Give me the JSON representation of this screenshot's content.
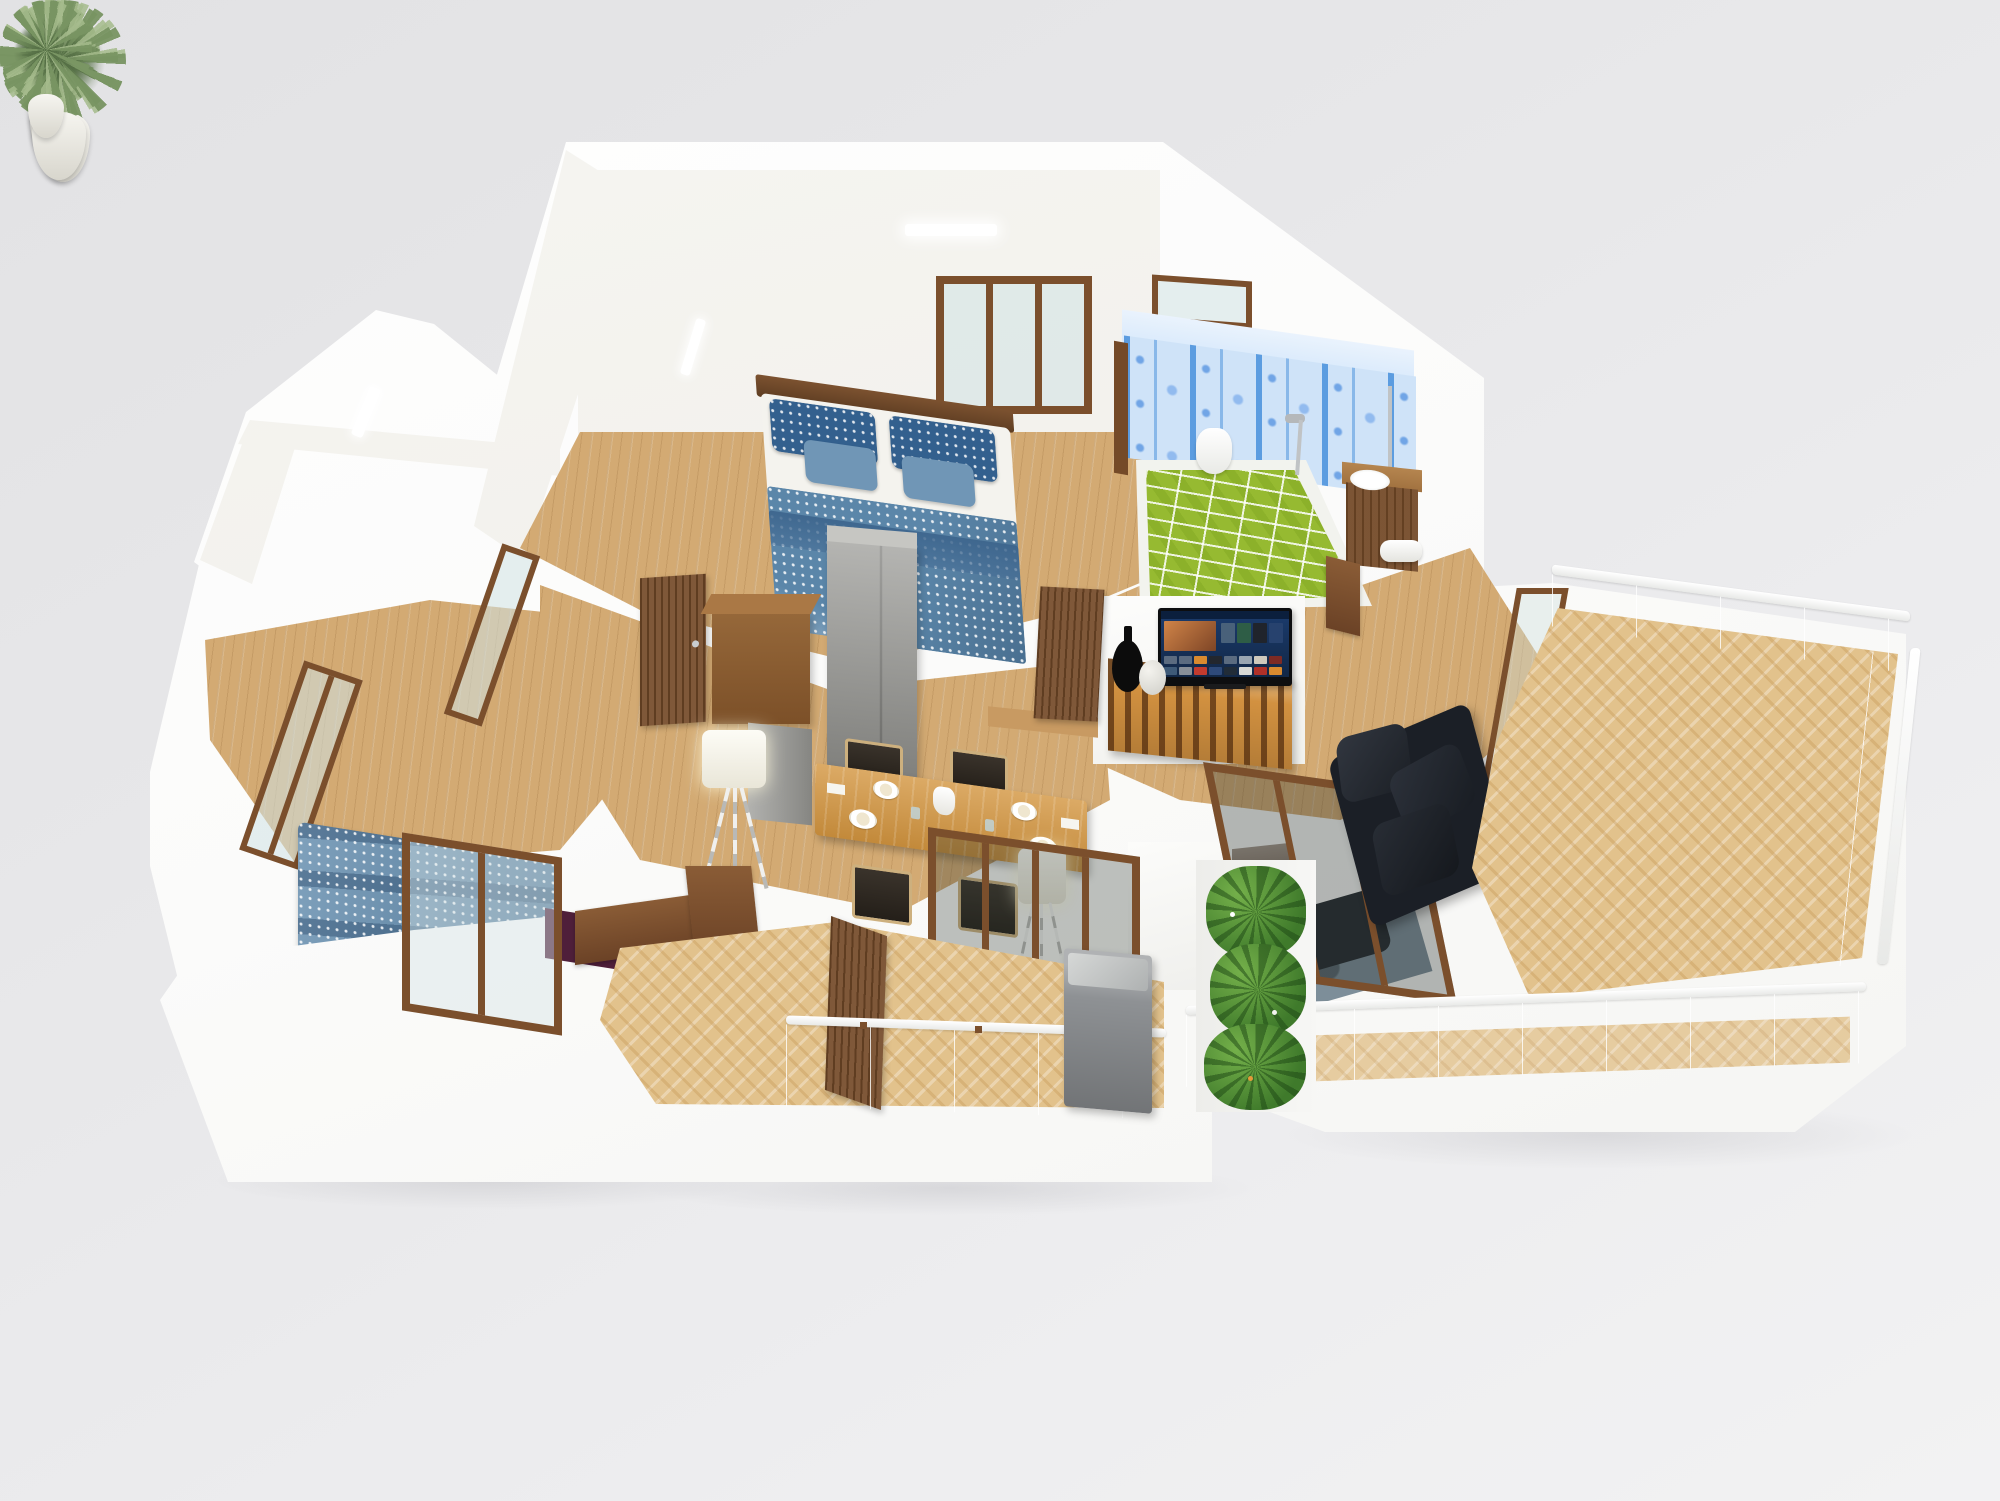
{
  "scene": {
    "description": "3D isometric cutaway floor plan render of a penthouse apartment level with bedrooms, bathroom, living-dining room, balcony, terrace and staircase",
    "background": "#e7e7e9",
    "colors": {
      "wall_white": "#fcfcfb",
      "wall_cream": "#efece5",
      "floor_wood": "#d3aa73",
      "floor_herringbone": "#e2c28c",
      "bed_blue": "#5b86a9",
      "pillow_dark_blue": "#33608e",
      "pillow_light_blue": "#7096b6",
      "wallpaper_blue": "#cfe3f8",
      "stripe_blue": "#4f95dd",
      "tile_green": "#96ba31",
      "sofa_black": "#1b1f26",
      "console_orange": "#d29140",
      "table_orange": "#d3953f",
      "door_wood": "#744a28",
      "rug_purple": "#4f1f3a",
      "rug_gray_blue": "#70838f",
      "plant_green": "#85a06e",
      "planter_green": "#47822f",
      "glass_tint": "#cfe4e1",
      "appliance_gray": "#8e9194",
      "fridge_gray": "#989894",
      "stair_wood": "#d9a863",
      "lamp_white": "#f3efe2"
    },
    "tv": {
      "thumbnails": [
        "#49617a",
        "#2e5d46",
        "#20242c",
        "#27426e"
      ],
      "screen_tiles_row1": [
        "#5b6b80",
        "#5b6b80",
        "#d98a2f",
        "#23272e",
        "#5b6b80",
        "#9aa5b1",
        "#cfc9bd",
        "#7d2a24"
      ],
      "screen_tiles_row2": [
        "#3e5a78",
        "#888f98",
        "#c23b2e",
        "#2e4a7a",
        "#212c38",
        "#d8d8d4",
        "#b03028",
        "#d98a2f"
      ]
    },
    "rooms": [
      {
        "name": "master-bedroom",
        "furniture": [
          "double-bed",
          "gray-wardrobe",
          "potted-plant",
          "potted-plant",
          "triple-window",
          "high-window",
          "ceiling-light",
          "open-door",
          "wood-cabinet"
        ]
      },
      {
        "name": "bathroom",
        "furniture": [
          "green-tiled-tub",
          "toilet",
          "shower-set",
          "wood-vanity-sink",
          "towel-roll",
          "patterned-wallpaper"
        ]
      },
      {
        "name": "living-dining",
        "furniture": [
          "dining-table",
          "dining-chairs",
          "refrigerator",
          "tv",
          "tv-console",
          "vases",
          "black-sofa",
          "coffee-table",
          "newspaper",
          "floor-lamp",
          "armchairs",
          "rug"
        ]
      },
      {
        "name": "second-bedroom",
        "furniture": [
          "double-bed",
          "purple-rug",
          "potted-plant",
          "glass-screen",
          "wall-windows",
          "floor-lamp"
        ]
      },
      {
        "name": "balcony",
        "furniture": [
          "glass-railing",
          "herringbone-floor",
          "outdoor-appliance",
          "open-door"
        ]
      },
      {
        "name": "terrace",
        "furniture": [
          "glass-balustrade",
          "herringbone-floor",
          "potted-plant",
          "staircase",
          "white-railing"
        ]
      },
      {
        "name": "planter",
        "furniture": [
          "green-plants"
        ]
      }
    ]
  }
}
